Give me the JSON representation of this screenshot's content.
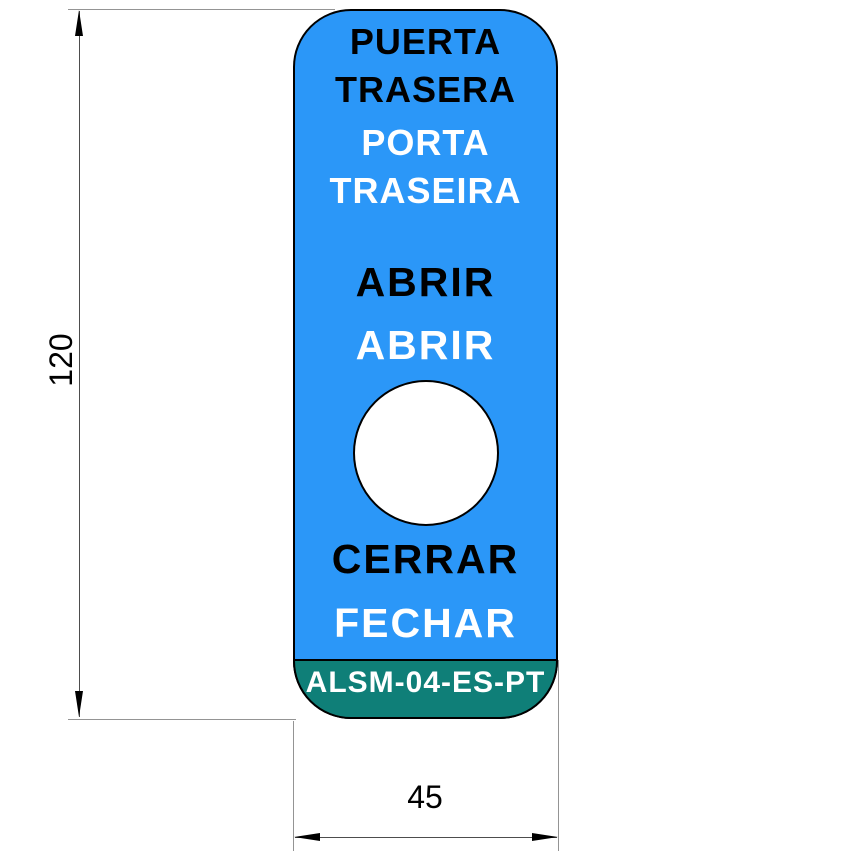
{
  "plate": {
    "texts": {
      "door_es_line1": "PUERTA",
      "door_es_line2": "TRASERA",
      "door_pt_line1": "PORTA",
      "door_pt_line2": "TRASEIRA",
      "open_es": "ABRIR",
      "open_pt": "ABRIR",
      "close_es": "CERRAR",
      "close_pt": "FECHAR",
      "part_number": "ALSM-04-ES-PT"
    },
    "colors": {
      "plate_blue": "#2B97F8",
      "footer_teal": "#0F7F78",
      "outline_black": "#000000",
      "hole_white": "#FFFFFF",
      "text_black": "#000000",
      "text_white": "#FFFFFF"
    }
  },
  "dimensions": {
    "height": "120",
    "width": "45"
  }
}
